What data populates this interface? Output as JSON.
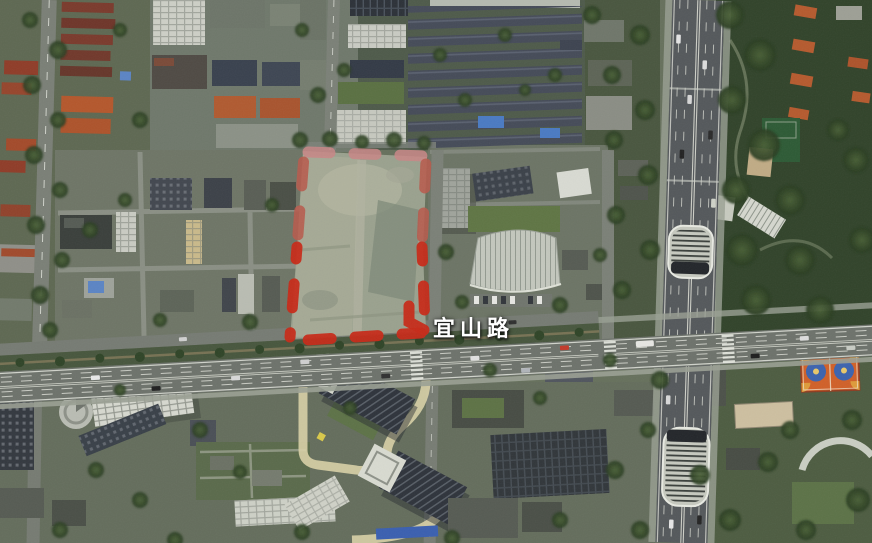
{
  "labels": {
    "road": "宜山路"
  },
  "annotations": {
    "site_boundary": {
      "shape": "dashed-polygon",
      "area": "vacant-lot-north-of-road"
    }
  },
  "theme": {
    "label-color": "#ffffff",
    "boundary-north": "#c98686",
    "boundary-side-upper": "#b75a4c",
    "boundary-main": "#c62a18",
    "court-orange": "#d06028",
    "court-blue": "#3c63ae"
  }
}
